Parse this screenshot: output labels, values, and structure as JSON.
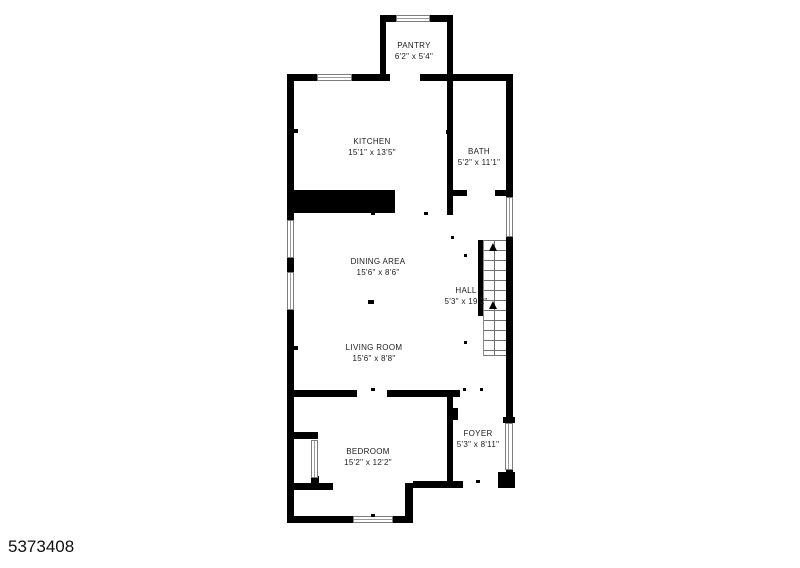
{
  "page": {
    "background": "#ffffff",
    "plan_id": "5373408"
  },
  "colors": {
    "wall": "#000000",
    "window_border": "#7d7d7d",
    "label": "#1c1c1c"
  },
  "rooms": [
    {
      "id": "pantry",
      "label": "PANTRY",
      "dims": "6'2\" x 5'4\""
    },
    {
      "id": "kitchen",
      "label": "KITCHEN",
      "dims": "15'1\" x 13'5\""
    },
    {
      "id": "bath",
      "label": "BATH",
      "dims": "5'2\" x 11'1\""
    },
    {
      "id": "dining-area",
      "label": "DINING AREA",
      "dims": "15'6\" x 8'6\""
    },
    {
      "id": "hall",
      "label": "HALL",
      "dims": "5'3\" x 19'2\""
    },
    {
      "id": "living-room",
      "label": "LIVING ROOM",
      "dims": "15'6\" x 8'8\""
    },
    {
      "id": "foyer",
      "label": "FOYER",
      "dims": "5'3\" x 8'11\""
    },
    {
      "id": "bedroom",
      "label": "BEDROOM",
      "dims": "15'2\" x 12'2\""
    }
  ],
  "features": {
    "stairs_direction": "up",
    "window_count": 7,
    "door_openings": [
      "pantry",
      "bath",
      "bedroom",
      "bedroom-closet",
      "front-entry"
    ]
  }
}
